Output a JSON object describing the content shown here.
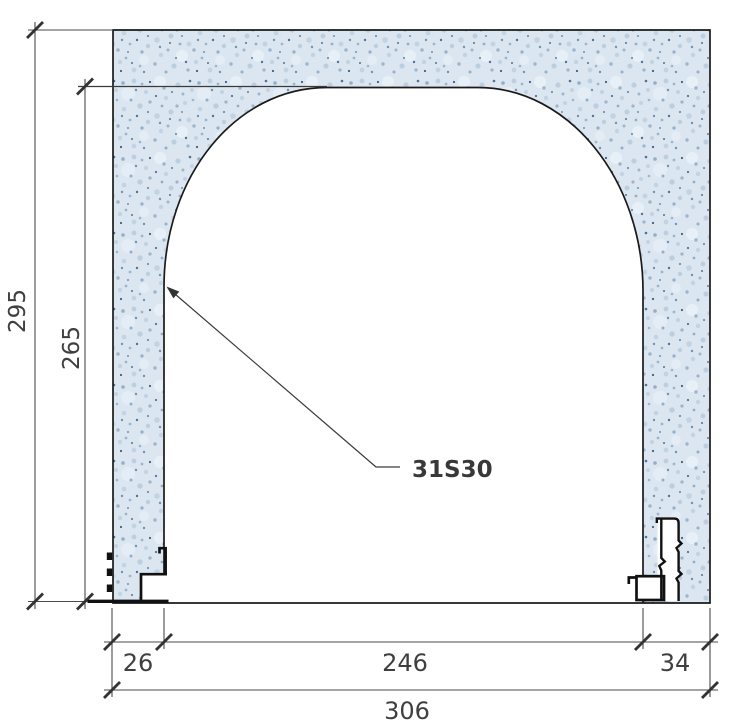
{
  "drawing": {
    "component_label": "31S30",
    "dimensions": {
      "overall_height": "295",
      "opening_height": "265",
      "left_pier_width": "26",
      "opening_width": "246",
      "right_pier_width": "34",
      "overall_width": "306"
    },
    "colors": {
      "wall_fill_base": "#dbe6f1",
      "speckle_light": "#eaf1f8",
      "speckle_mid": "#c2d3e3",
      "speckle_deep": "#9cb6ce",
      "speckle_dark": "#6f93b2",
      "speckle_darkest": "#4f7294",
      "outline": "#1a1a1a",
      "dimension_line": "#4a4a4a",
      "text": "#3f3f3f",
      "background": "#ffffff"
    }
  }
}
